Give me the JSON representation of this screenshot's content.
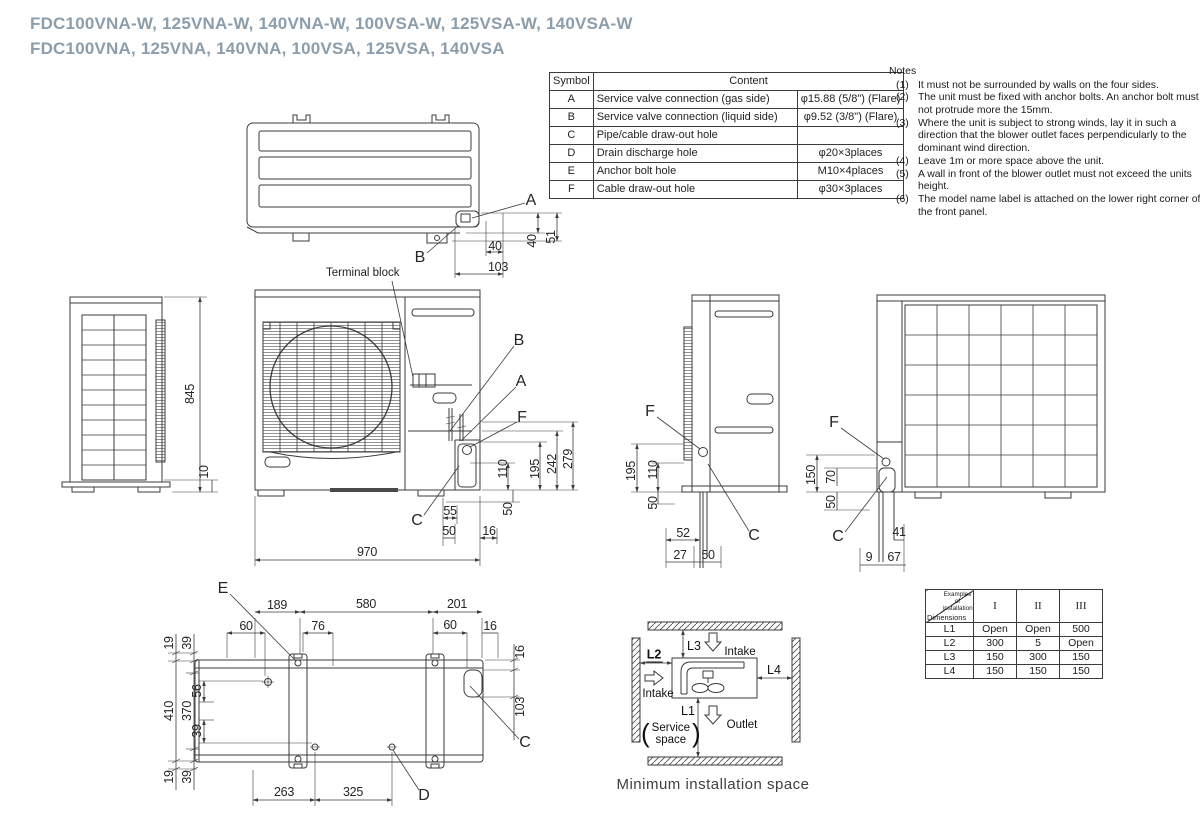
{
  "title": {
    "line1": "FDC100VNA-W, 125VNA-W, 140VNA-W, 100VSA-W, 125VSA-W, 140VSA-W",
    "line2": "FDC100VNA, 125VNA, 140VNA, 100VSA, 125VSA, 140VSA"
  },
  "symbol_table": {
    "col_symbol": "Symbol",
    "col_content": "Content",
    "rows": [
      {
        "symbol": "A",
        "content": "Service valve connection (gas side)",
        "value": "φ15.88 (5/8\") (Flare)"
      },
      {
        "symbol": "B",
        "content": "Service valve connection (liquid side)",
        "value": "φ9.52 (3/8\") (Flare)"
      },
      {
        "symbol": "C",
        "content": "Pipe/cable draw-out hole",
        "value": ""
      },
      {
        "symbol": "D",
        "content": "Drain discharge hole",
        "value": "φ20×3places"
      },
      {
        "symbol": "E",
        "content": "Anchor bolt hole",
        "value": "M10×4places"
      },
      {
        "symbol": "F",
        "content": "Cable draw-out hole",
        "value": "φ30×3places"
      }
    ]
  },
  "notes": {
    "title": "Notes",
    "items": [
      {
        "num": "(1)",
        "text": "It must not be surrounded by walls on the four sides."
      },
      {
        "num": "(2)",
        "text": "The unit must be fixed with anchor bolts. An anchor bolt must not protrude more the 15mm."
      },
      {
        "num": "(3)",
        "text": "Where the unit is subject to strong winds, lay it in such a direction that the blower outlet faces perpendicularly to the dominant wind direction."
      },
      {
        "num": "(4)",
        "text": "Leave 1m or more space above the unit."
      },
      {
        "num": "(5)",
        "text": "A wall in front of the blower outlet must not exceed the units height."
      },
      {
        "num": "(6)",
        "text": "The model name label is attached on the lower right corner of the front panel."
      }
    ]
  },
  "drawing": {
    "terminal_block_label": "Terminal block",
    "labels": [
      {
        "t": "A",
        "x": 531,
        "y": 201,
        "k": "callout"
      },
      {
        "t": "B",
        "x": 420,
        "y": 258,
        "k": "callout"
      },
      {
        "t": "40",
        "x": 532,
        "y": 241,
        "r": 1
      },
      {
        "t": "51",
        "x": 551,
        "y": 237,
        "r": 1
      },
      {
        "t": "40",
        "x": 495,
        "y": 246
      },
      {
        "t": "103",
        "x": 498,
        "y": 267
      },
      {
        "t": "845",
        "x": 190,
        "y": 394,
        "r": 1
      },
      {
        "t": "10",
        "x": 204,
        "y": 472,
        "r": 1
      },
      {
        "t": "B",
        "x": 519,
        "y": 341,
        "k": "callout"
      },
      {
        "t": "A",
        "x": 521,
        "y": 382,
        "k": "callout"
      },
      {
        "t": "F",
        "x": 522,
        "y": 418,
        "k": "callout"
      },
      {
        "t": "C",
        "x": 417,
        "y": 521,
        "k": "callout"
      },
      {
        "t": "110",
        "x": 503,
        "y": 469,
        "r": 1
      },
      {
        "t": "195",
        "x": 535,
        "y": 469,
        "r": 1
      },
      {
        "t": "242",
        "x": 552,
        "y": 464,
        "r": 1
      },
      {
        "t": "279",
        "x": 568,
        "y": 459,
        "r": 1
      },
      {
        "t": "50",
        "x": 508,
        "y": 509,
        "r": 1
      },
      {
        "t": "55",
        "x": 450,
        "y": 511
      },
      {
        "t": "50",
        "x": 449,
        "y": 531
      },
      {
        "t": "16",
        "x": 489,
        "y": 531
      },
      {
        "t": "970",
        "x": 367,
        "y": 552
      },
      {
        "t": "F",
        "x": 650,
        "y": 412,
        "k": "callout"
      },
      {
        "t": "C",
        "x": 754,
        "y": 536,
        "k": "callout"
      },
      {
        "t": "195",
        "x": 631,
        "y": 471,
        "r": 1
      },
      {
        "t": "110",
        "x": 653,
        "y": 470,
        "r": 1
      },
      {
        "t": "50",
        "x": 653,
        "y": 503,
        "r": 1
      },
      {
        "t": "52",
        "x": 683,
        "y": 533
      },
      {
        "t": "27",
        "x": 680,
        "y": 555
      },
      {
        "t": "50",
        "x": 708,
        "y": 555
      },
      {
        "t": "F",
        "x": 834,
        "y": 423,
        "k": "callout"
      },
      {
        "t": "C",
        "x": 838,
        "y": 537,
        "k": "callout"
      },
      {
        "t": "150",
        "x": 811,
        "y": 475,
        "r": 1
      },
      {
        "t": "70",
        "x": 831,
        "y": 477,
        "r": 1
      },
      {
        "t": "50",
        "x": 831,
        "y": 502,
        "r": 1
      },
      {
        "t": "41",
        "x": 899,
        "y": 532
      },
      {
        "t": "9",
        "x": 869,
        "y": 557
      },
      {
        "t": "67",
        "x": 894,
        "y": 557
      },
      {
        "t": "E",
        "x": 223,
        "y": 589,
        "k": "callout"
      },
      {
        "t": "D",
        "x": 424,
        "y": 796,
        "k": "callout"
      },
      {
        "t": "C",
        "x": 525,
        "y": 743,
        "k": "callout"
      },
      {
        "t": "189",
        "x": 277,
        "y": 605
      },
      {
        "t": "580",
        "x": 366,
        "y": 604
      },
      {
        "t": "201",
        "x": 457,
        "y": 604
      },
      {
        "t": "60",
        "x": 246,
        "y": 626
      },
      {
        "t": "76",
        "x": 318,
        "y": 626
      },
      {
        "t": "60",
        "x": 450,
        "y": 625
      },
      {
        "t": "16",
        "x": 490,
        "y": 626
      },
      {
        "t": "19",
        "x": 169,
        "y": 643,
        "r": 1
      },
      {
        "t": "39",
        "x": 187,
        "y": 643,
        "r": 1
      },
      {
        "t": "410",
        "x": 169,
        "y": 711,
        "r": 1
      },
      {
        "t": "370",
        "x": 187,
        "y": 711,
        "r": 1
      },
      {
        "t": "56",
        "x": 197,
        "y": 691,
        "r": 1
      },
      {
        "t": "39",
        "x": 197,
        "y": 731,
        "r": 1
      },
      {
        "t": "19",
        "x": 169,
        "y": 777,
        "r": 1
      },
      {
        "t": "39",
        "x": 187,
        "y": 777,
        "r": 1
      },
      {
        "t": "16",
        "x": 520,
        "y": 652,
        "r": 1
      },
      {
        "t": "103",
        "x": 520,
        "y": 707,
        "r": 1
      },
      {
        "t": "263",
        "x": 284,
        "y": 792
      },
      {
        "t": "325",
        "x": 353,
        "y": 792
      }
    ]
  },
  "install_space": {
    "caption": "Minimum installation space",
    "l1": "L1",
    "l2": "L2",
    "l3": "L3",
    "l4": "L4",
    "intake_left": "Intake",
    "intake_top": "Intake",
    "outlet": "Outlet",
    "paren_open": "(",
    "paren_close": ")",
    "service_line1": "Service",
    "service_line2": "space"
  },
  "install_table": {
    "corner_top": "Examples of installation",
    "corner_bottom": "Dimensions",
    "columns": [
      "I",
      "II",
      "III"
    ],
    "rows": [
      {
        "label": "L1",
        "values": [
          "Open",
          "Open",
          "500"
        ]
      },
      {
        "label": "L2",
        "values": [
          "300",
          "5",
          "Open"
        ]
      },
      {
        "label": "L3",
        "values": [
          "150",
          "300",
          "150"
        ]
      },
      {
        "label": "L4",
        "values": [
          "150",
          "150",
          "150"
        ]
      }
    ]
  },
  "colors": {
    "line": "#3b3b3b",
    "title": "#8c9dab",
    "text": "#262626"
  }
}
